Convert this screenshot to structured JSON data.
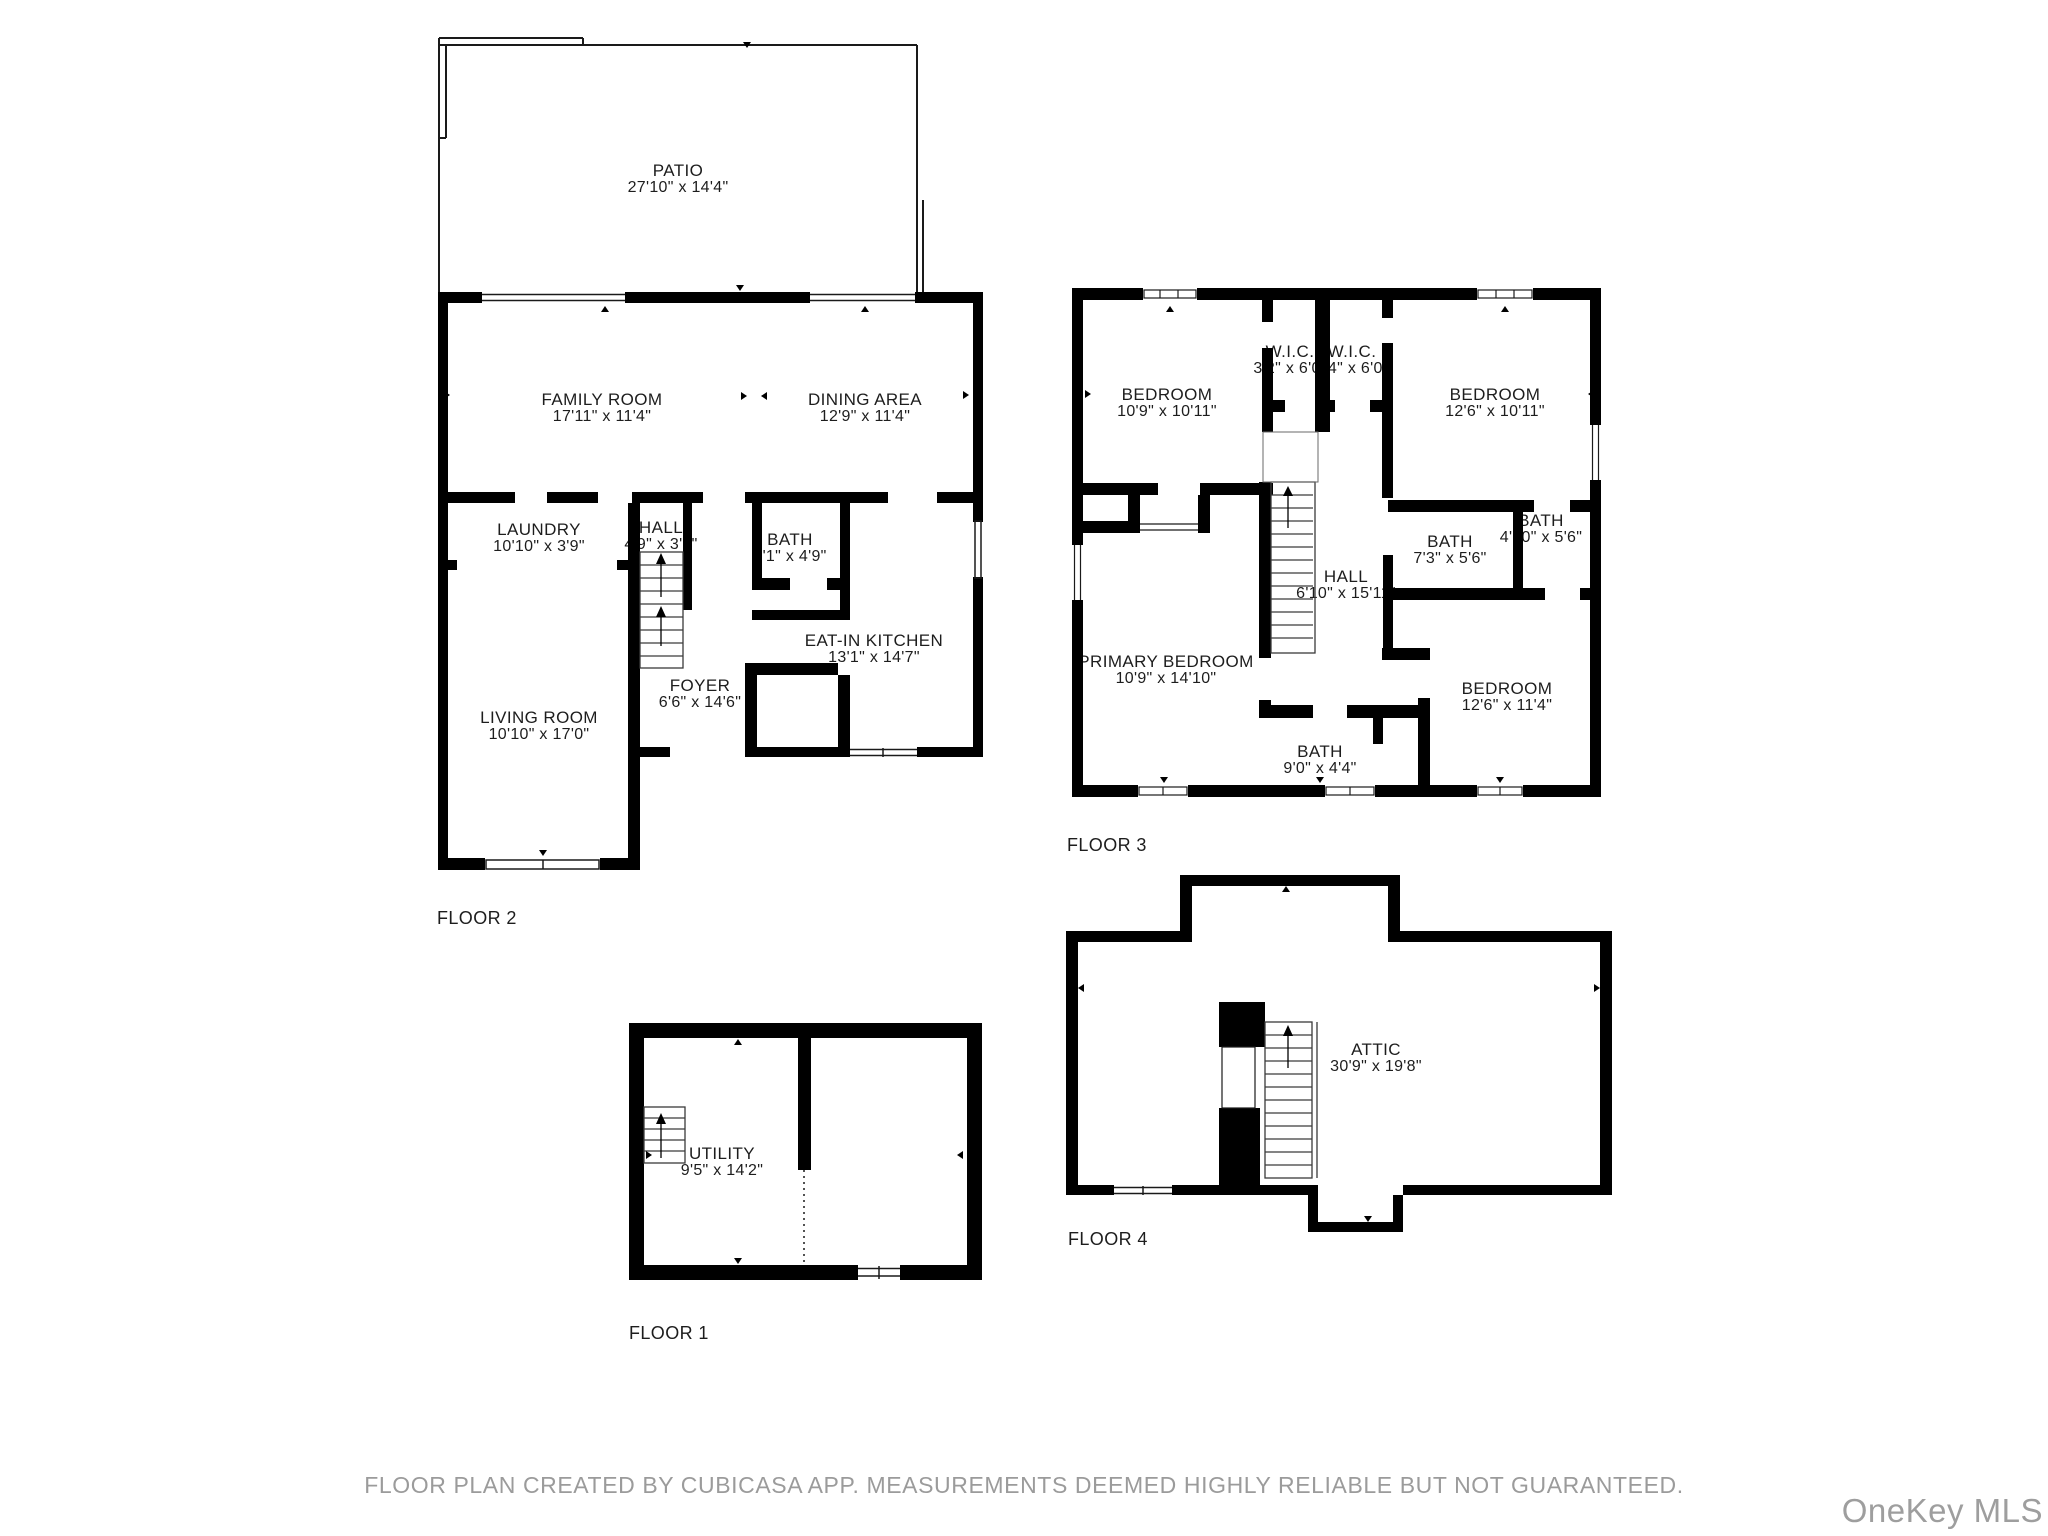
{
  "colors": {
    "wall": "#000000",
    "text": "#1d1d1d",
    "muted": "#9b9b9b"
  },
  "footer": {
    "disclaimer": "FLOOR PLAN CREATED BY CUBICASA APP. MEASUREMENTS DEEMED HIGHLY RELIABLE BUT NOT GUARANTEED.",
    "watermark": "OneKey MLS"
  },
  "floors": [
    {
      "id": "floor-2",
      "label": "FLOOR 2",
      "label_pos": {
        "x": 437,
        "y": 908
      },
      "rooms": [
        {
          "name": "PATIO",
          "dims": "27'10\" x 14'4\"",
          "x": 678,
          "y": 163
        },
        {
          "name": "FAMILY ROOM",
          "dims": "17'11\" x 11'4\"",
          "x": 602,
          "y": 392
        },
        {
          "name": "DINING AREA",
          "dims": "12'9\" x 11'4\"",
          "x": 865,
          "y": 392
        },
        {
          "name": "LAUNDRY",
          "dims": "10'10\" x 3'9\"",
          "x": 539,
          "y": 522
        },
        {
          "name": "HALL",
          "dims": "4'9\" x 3'2\"",
          "x": 661,
          "y": 520
        },
        {
          "name": "BATH",
          "dims": "5'1\" x 4'9\"",
          "x": 790,
          "y": 532
        },
        {
          "name": "EAT-IN KITCHEN",
          "dims": "13'1\" x 14'7\"",
          "x": 874,
          "y": 633
        },
        {
          "name": "FOYER",
          "dims": "6'6\" x 14'6\"",
          "x": 700,
          "y": 678
        },
        {
          "name": "LIVING ROOM",
          "dims": "10'10\" x 17'0\"",
          "x": 539,
          "y": 710
        }
      ]
    },
    {
      "id": "floor-3",
      "label": "FLOOR 3",
      "label_pos": {
        "x": 1067,
        "y": 835
      },
      "rooms": [
        {
          "name": "BEDROOM",
          "dims": "10'9\" x 10'11\"",
          "x": 1167,
          "y": 387
        },
        {
          "name": "W.I.C.",
          "dims": "3'2\" x 6'0\"",
          "x": 1290,
          "y": 344
        },
        {
          "name": "W.I.C.",
          "dims": "3'4\" x 6'0\"",
          "x": 1352,
          "y": 344
        },
        {
          "name": "BEDROOM",
          "dims": "12'6\" x 10'11\"",
          "x": 1495,
          "y": 387
        },
        {
          "name": "BATH",
          "dims": "4'10\" x 5'6\"",
          "x": 1541,
          "y": 513
        },
        {
          "name": "BATH",
          "dims": "7'3\" x 5'6\"",
          "x": 1450,
          "y": 534
        },
        {
          "name": "HALL",
          "dims": "6'10\" x 15'11\"",
          "x": 1346,
          "y": 569
        },
        {
          "name": "PRIMARY BEDROOM",
          "dims": "10'9\" x 14'10\"",
          "x": 1166,
          "y": 654
        },
        {
          "name": "BATH",
          "dims": "9'0\" x 4'4\"",
          "x": 1320,
          "y": 744
        },
        {
          "name": "BEDROOM",
          "dims": "12'6\" x 11'4\"",
          "x": 1507,
          "y": 681
        }
      ]
    },
    {
      "id": "floor-1",
      "label": "FLOOR 1",
      "label_pos": {
        "x": 629,
        "y": 1323
      },
      "rooms": [
        {
          "name": "UTILITY",
          "dims": "9'5\" x 14'2\"",
          "x": 722,
          "y": 1146
        }
      ]
    },
    {
      "id": "floor-4",
      "label": "FLOOR 4",
      "label_pos": {
        "x": 1068,
        "y": 1229
      },
      "rooms": [
        {
          "name": "ATTIC",
          "dims": "30'9\" x 19'8\"",
          "x": 1376,
          "y": 1042
        }
      ]
    }
  ]
}
